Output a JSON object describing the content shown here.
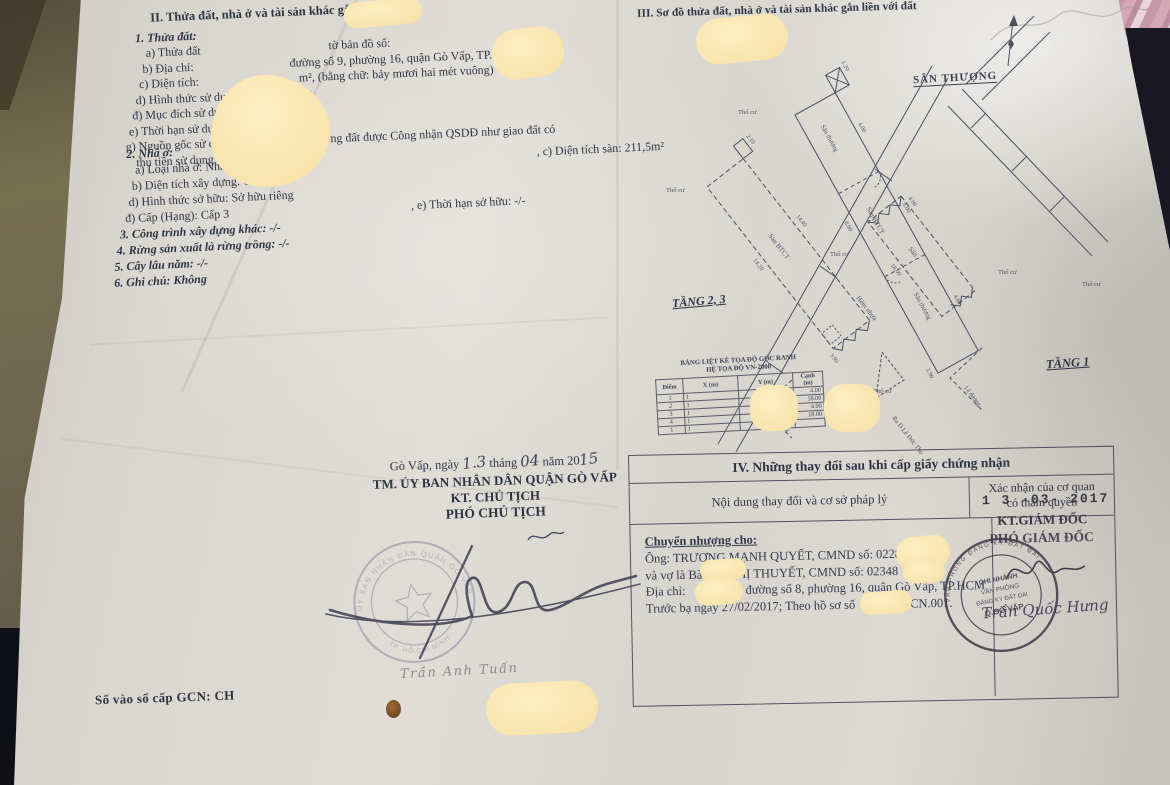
{
  "palette": {
    "paper": "#d9d6d0",
    "ink": "#2e3443",
    "redaction": "#f8e4b0",
    "background_left": "#6e6750",
    "background_dark": "#14151c",
    "fabric_pink": "#cf9fae",
    "stamp_faded": "#8d85a0",
    "stamp_dark": "#45424e"
  },
  "section_land": {
    "heading": "II. Thửa đất, nhà ở và tài sản khác gắn liền với đất",
    "sub_heading": "1. Thửa đất:",
    "a_label": "a) Thửa đất",
    "a_value": "tờ bản đồ số:",
    "b_label": "b) Địa chỉ:",
    "b_value": "đường số 9, phường 16, quận Gò Vấp, TP. HCM",
    "c_label": "c) Diện tích:",
    "c_value": "m², (bằng chữ: bảy mươi hai mét vuông)",
    "d_line": "d) Hình thức sử dụng:  Sử dụng riêng",
    "dd_line": "đ) Mục đích sử dụng:  Đất ở tại đô thị",
    "e_line": "e) Thời hạn sử dụng:  Lâu dài",
    "g_line": "g) Nguồn gốc sử dụng:  Nhận chuyển nhượng đất được Công nhận QSDĐ như giao đất có",
    "g_line2": "thu tiền sử dụng đất"
  },
  "section_house": {
    "heading": "2. Nhà ở:",
    "a_line": "a) Loại nhà ở:    Nhà ở riêng lẻ",
    "c_line": ", c) Diện tích sàn:    211,5m²",
    "b_line": "b) Diện tích xây dựng:    60,2m²",
    "d_line": "d) Hình thức sở hữu:    Sở hữu riêng",
    "dd_line": "đ) Cấp (Hạng):  Cấp 3",
    "e_line": ", e) Thời hạn sở hữu:    -/-",
    "item3": "3. Công trình xây dựng khác: -/-",
    "item4": "4. Rừng sản xuất là rừng trồng: -/-",
    "item5": "5. Cây lâu năm:  -/-",
    "item6": "6. Ghi chú: Không"
  },
  "issue": {
    "date_pre": "Gò Vấp, ngày",
    "date_day": "1.3",
    "thang": "tháng",
    "date_month": "04",
    "nam": "năm 20",
    "date_year": "15",
    "committee": "TM. ỦY BAN NHÂN DÂN QUẬN GÒ VẤP",
    "kt_chu_tich": "KT. CHỦ TỊCH",
    "pho_chu_tich": "PHÓ CHỦ TỊCH",
    "signer_name": "Trần Anh Tuấn",
    "stamp_top": "ỦY BAN NHÂN DÂN QUẬN GÒ VẤP",
    "stamp_bottom": "TP. HỒ CHÍ MINH"
  },
  "gcn": {
    "label": "Số vào sổ cấp GCN: CH"
  },
  "diagram": {
    "heading": "III. Sơ đồ thửa đất, nhà ở và tài sản khác gắn liền với đất",
    "san_thuong_label": "SÂN THƯỢNG",
    "tang23_label": "TẦNG 2, 3",
    "tang1_label": "TẦNG 1",
    "san_btct": "Sàn BTCT",
    "san_thuong_small": "Sân thượng",
    "san": "Sân",
    "tho_cu": "Thổ cư",
    "le_duong": "Lề đường",
    "hem": "Hẻm nhựa",
    "ra_duong": "Ra Đ.Lê Đức Thọ",
    "dims": [
      "4.00",
      "8.00",
      "14.20",
      "14.40",
      "2.90",
      "1.20",
      "4.60",
      "3.90",
      "18.00",
      "2.10"
    ],
    "coord_table": {
      "title1": "BẢNG LIỆT KÊ TỌA ĐỘ GÓC RANH",
      "title2": "HỆ TỌA ĐỘ VN-2000",
      "headers": [
        "Điểm",
        "X (m)",
        "Y (m)",
        "Cạnh (m)"
      ],
      "rows": [
        [
          "1",
          "1",
          "",
          "4.00"
        ],
        [
          "2",
          "1",
          "",
          "18.00"
        ],
        [
          "3",
          "1",
          "",
          "4.00"
        ],
        [
          "4",
          "1",
          "",
          "18.00"
        ],
        [
          "1",
          "1",
          "",
          ""
        ]
      ]
    }
  },
  "changes": {
    "title": "IV. Những thay đổi sau khi cấp giấy chứng nhận",
    "col_content": "Nội dung thay đổi và cơ sở pháp lý",
    "col_confirm1": "Xác nhận của cơ quan",
    "col_confirm2": "có thẩm quyền",
    "transfer_heading": "Chuyển nhượng cho:",
    "line1": "Ông: TRƯƠNG MẠNH QUYẾT, CMND số: 0228",
    "line2": "và vợ là Bà: VÕ THỊ THUYẾT, CMND số: 02348",
    "line3_label": "Địa chỉ:",
    "line3_value": "đường số 8, phường 16, quận Gò Vấp, TP.HCM",
    "line4_pre": "Trước bạ ngày 27/02/2017; Theo hồ sơ số",
    "line4_post": "CN.001.",
    "date_stamp": "1 3  -03-  2017",
    "kt_giam_doc": "KT.GIÁM ĐỐC",
    "pho_giam_doc": "PHÓ GIÁM ĐỐC",
    "signer_name": "Trần Quốc Hưng",
    "stamp_line1": "CHI NHÁNH",
    "stamp_line2": "VĂN PHÒNG",
    "stamp_line3": "ĐĂNG KÝ ĐẤT ĐAI",
    "stamp_line4": "Q.GÒ VẤP",
    "stamp_arc": "VĂN PHÒNG ĐĂNG KÝ ĐẤT ĐAI"
  }
}
